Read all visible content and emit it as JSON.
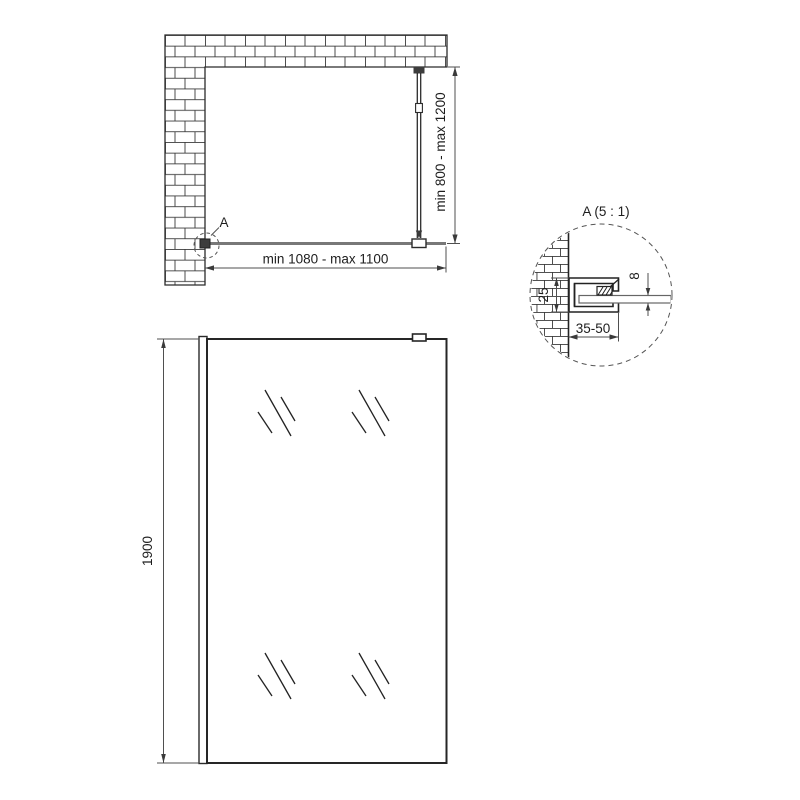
{
  "plan_view": {
    "width_dim": "min 1080 - max 1100",
    "bar_dim": "min 800 - max 1200",
    "detail_label": "A"
  },
  "detail_view": {
    "title": "A (5 : 1)",
    "profile_height_dim": "25",
    "glass_thickness_dim": "8",
    "wall_clearance_dim": "35-50"
  },
  "front_view": {
    "height_dim": "1900"
  },
  "colors": {
    "line": "#2b2b2b",
    "dimension": "#4f4f4f",
    "glass": "#787878",
    "background": "#ffffff"
  }
}
